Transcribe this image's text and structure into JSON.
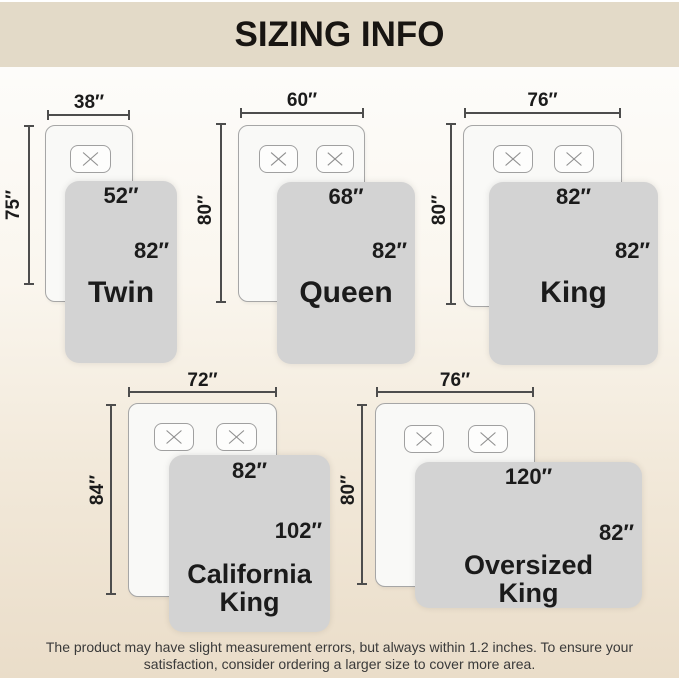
{
  "header": {
    "title": "SIZING INFO"
  },
  "beds": [
    {
      "id": "twin",
      "name": "Twin",
      "bed_width": "38″",
      "bed_length": "75″",
      "blanket_width": "52″",
      "blanket_length": "82″",
      "pillow_count": 1
    },
    {
      "id": "queen",
      "name": "Queen",
      "bed_width": "60″",
      "bed_length": "80″",
      "blanket_width": "68″",
      "blanket_length": "82″",
      "pillow_count": 2
    },
    {
      "id": "king",
      "name": "King",
      "bed_width": "76″",
      "bed_length": "80″",
      "blanket_width": "82″",
      "blanket_length": "82″",
      "pillow_count": 2
    },
    {
      "id": "california-king",
      "name": "California King",
      "bed_width": "72″",
      "bed_length": "84″",
      "blanket_width": "82″",
      "blanket_length": "102″",
      "pillow_count": 2
    },
    {
      "id": "oversized-king",
      "name": "Oversized King",
      "bed_width": "76″",
      "bed_length": "80″",
      "blanket_width": "120″",
      "blanket_length": "82″",
      "pillow_count": 2
    }
  ],
  "footer": {
    "line1": "The product may have slight measurement errors, but always within 1.2 inches. To ensure your",
    "line2": "satisfaction, consider ordering a larger size to cover more area."
  },
  "colors": {
    "header_bg": "#e3dac8",
    "page_bottom": "#eaddc9",
    "blanket": "#d3d3d3",
    "mattress": "#f9f9f7",
    "text": "#1b1b1b",
    "measure_line": "#4d4d4d"
  }
}
